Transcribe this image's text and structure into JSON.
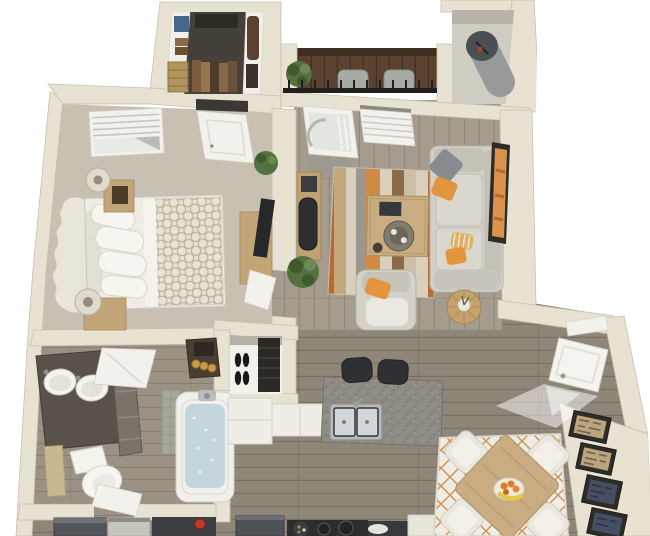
{
  "scene": {
    "type": "3d-floor-plan",
    "view": "top-down isometric architectural render, no visible text",
    "description": "3D rendered one-bedroom, one-bathroom apartment floor plan",
    "rooms": [
      {
        "id": "walk-in-closet",
        "contents": [
          "white shelving",
          "folded clothes",
          "wicker basket",
          "hanging garments"
        ]
      },
      {
        "id": "balcony",
        "contents": [
          "dark wood deck",
          "black railing",
          "two patio chairs",
          "potted plant"
        ]
      },
      {
        "id": "utility-closet",
        "contents": [
          "water heater"
        ]
      },
      {
        "id": "bedroom",
        "contents": [
          "bed with ornate headboard",
          "patterned duvet",
          "two nightstands",
          "two lamps",
          "window with blinds",
          "closet door",
          "dresser with tv",
          "plant",
          "open door"
        ]
      },
      {
        "id": "living-room",
        "contents": [
          "sectional sofa",
          "orange and gray pillows",
          "striped rug",
          "coffee table",
          "desk with office chair",
          "armchair",
          "round pouf with vase",
          "wall art",
          "sliding balcony door",
          "window",
          "door mat",
          "plant"
        ]
      },
      {
        "id": "bathroom",
        "contents": [
          "double-sink vanity",
          "mirror",
          "linen shelf with candles",
          "toilet",
          "bath mat",
          "bathtub",
          "tile surround",
          "open door"
        ]
      },
      {
        "id": "hall-closet",
        "contents": [
          "dark shelving",
          "two pairs of shoes"
        ]
      },
      {
        "id": "kitchen",
        "contents": [
          "white cabinets",
          "granite breakfast bar",
          "double stainless sink",
          "two bar stools",
          "refrigerator",
          "range cooktop",
          "counter"
        ]
      },
      {
        "id": "dining-area",
        "contents": [
          "lattice rug",
          "square wood table",
          "four white chairs",
          "fruit bowl with oranges and bananas"
        ]
      },
      {
        "id": "entry",
        "contents": [
          "open front door",
          "daylight spill",
          "four framed artworks"
        ]
      },
      {
        "id": "laundry-nook",
        "contents": [
          "washer",
          "dryer",
          "red kettle"
        ]
      }
    ]
  },
  "colors": {
    "wall": "#e7e2d2",
    "wall_edge": "#c8c1ab",
    "wall_face": "#d8d2c2",
    "carpet": "#c7c0b3",
    "wood_light": "#a59c8f",
    "wood_dark": "#8e8679",
    "wood_bath": "#9b9285",
    "balcony_floor": "#5a4130",
    "dark_interior": "#45413a",
    "white_trim": "#f2f1ec",
    "sofa": "#d2cfc7",
    "accent_orange": "#e2953c",
    "pillow_gray": "#878a8e",
    "wood_furniture": "#c2a678",
    "wood_table": "#c9ac82",
    "granite": "#8e8b84",
    "steel": "#d4d7d9",
    "appliance_dark": "#2b2d2f",
    "fridge": "#4e5155",
    "cabinet_white": "#efede6",
    "rug_cream": "#efece3",
    "lattice_orange": "#d09457",
    "plant_green": "#55713f",
    "plant_dark": "#3e5a2e",
    "frame_tan": "#bca57c",
    "frame_navy": "#454e62",
    "frame_border": "#2e2c28",
    "vanity_dark": "#59524a",
    "water_blue": "#c3d6dc",
    "gold": "#c79a4c",
    "red_accent": "#c13b2c",
    "tv_black": "#26282b",
    "chair_black": "#2c2d2f",
    "stool_black": "#2e3034",
    "railing_black": "#22201c"
  }
}
